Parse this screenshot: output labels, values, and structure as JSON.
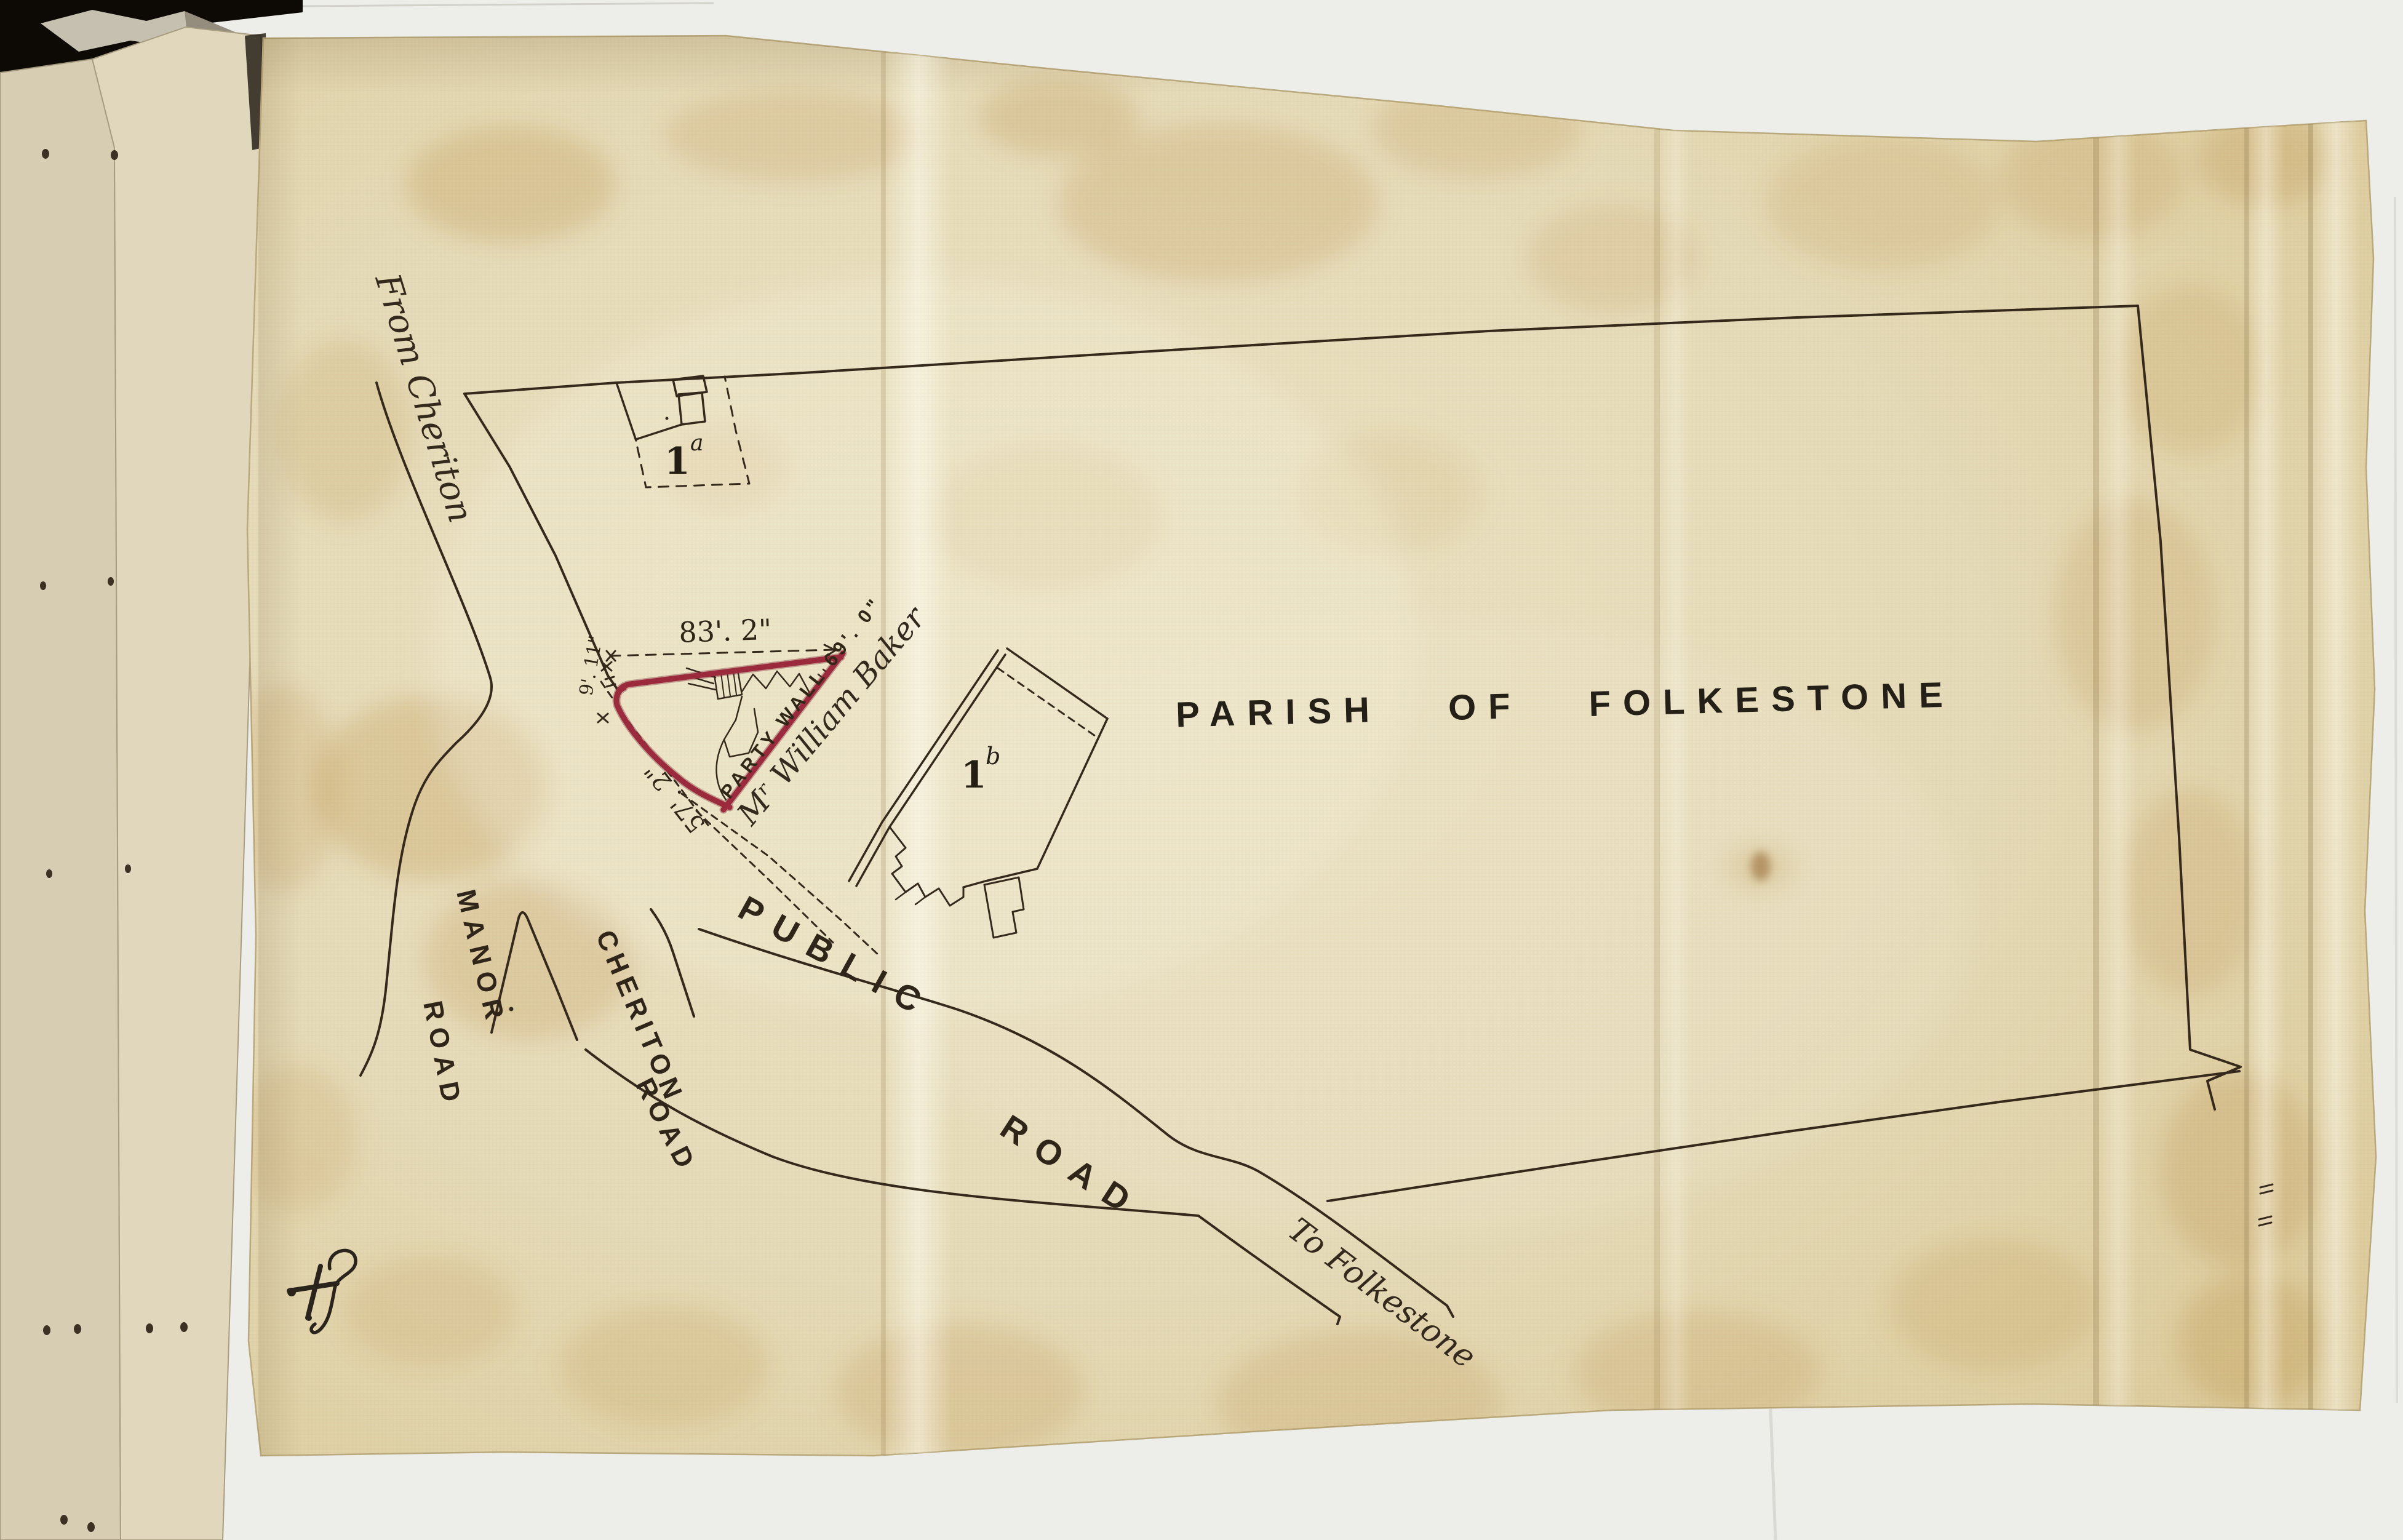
{
  "colors": {
    "backing": "#edeeea",
    "black_gap": "#0d0a06",
    "page_left": "#d6cdb2",
    "page_right": "#e0d7bc",
    "sheet_base": "#e6dcba",
    "sheet_edge": "#d8c694",
    "ink": "#35291c",
    "plot_red": "#9c2a3d",
    "stain": "#b98a3f"
  },
  "parish_label": "PARISH OF FOLKESTONE",
  "roads": {
    "from_cheriton": "From Cheriton",
    "to_folkestone": "To Folkestone",
    "public_1": "PUBLIC",
    "public_2": "ROAD",
    "manor_1": "MANOR",
    "manor_2": "ROAD",
    "cheriton_1": "CHERITON",
    "cheriton_2": "ROAD"
  },
  "parcels": {
    "a_num": "1",
    "a_sup": "a",
    "b_num": "1",
    "b_sup": "b"
  },
  "plot": {
    "owner": "Mʳ William Baker",
    "party_wall": "PARTY WALL 69'. 0\"",
    "dim_top": "83'. 2\"",
    "dim_side": "57'. 2\"",
    "dim_corner": "9'. 11\""
  }
}
